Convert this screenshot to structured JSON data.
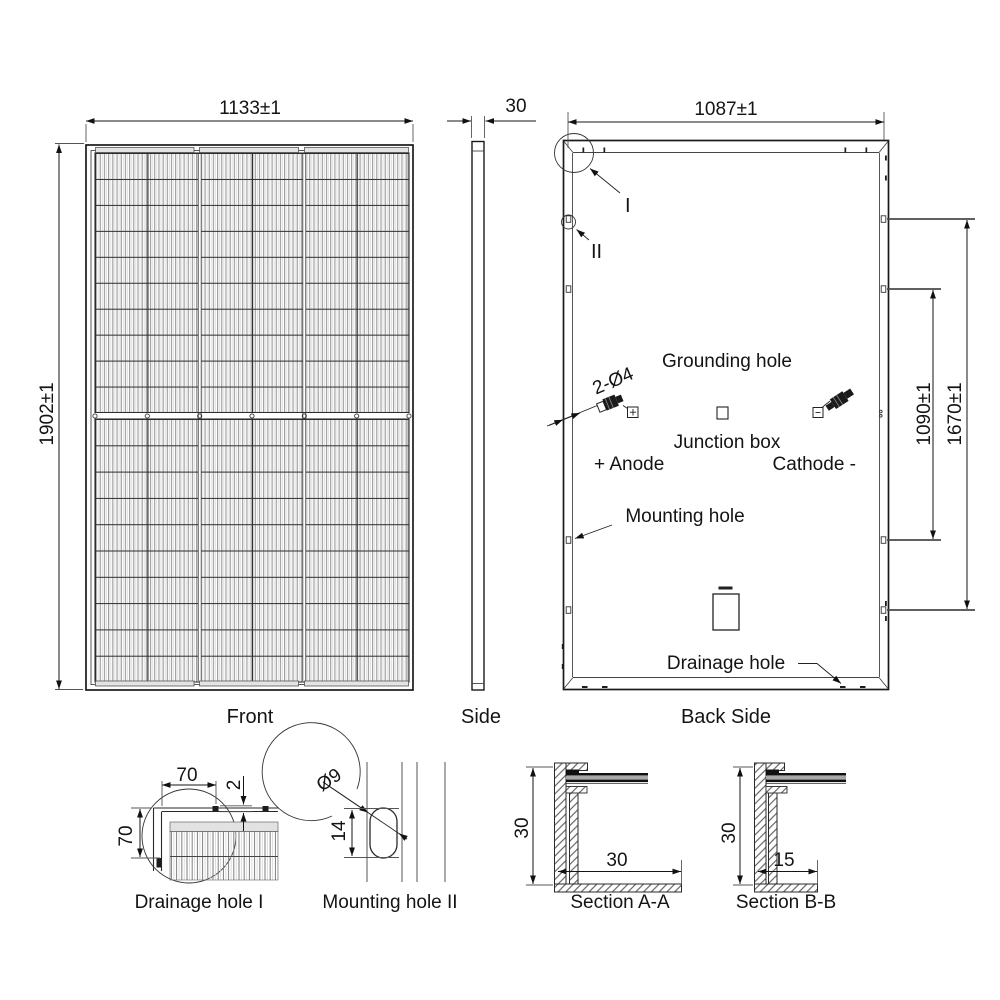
{
  "drawing": {
    "front": {
      "caption": "Front",
      "width_dim": "1133±1",
      "height_dim": "1902±1"
    },
    "side": {
      "caption": "Side",
      "thickness_dim": "30"
    },
    "back": {
      "caption": "Back Side",
      "width_dim": "1087±1",
      "inner_hole_span_dim": "1090±1",
      "outer_hole_span_dim": "1670±1",
      "grounding_hole_label": "Grounding hole",
      "grounding_hole_spec": "2-Ø4",
      "junction_box_label": "Junction box",
      "anode_label": "+ Anode",
      "cathode_label": "Cathode -",
      "mounting_hole_label": "Mounting hole",
      "drainage_hole_label": "Drainage hole",
      "detail_marker_1": "I",
      "detail_marker_2": "II"
    },
    "drainage_detail": {
      "caption": "Drainage hole I",
      "width_dim": "70",
      "height_dim": "70",
      "slot_dim": "2"
    },
    "mounting_detail": {
      "caption": "Mounting hole II",
      "diameter_dim": "Ø9",
      "length_dim": "14"
    },
    "section_aa": {
      "caption": "Section A-A",
      "height_dim": "30",
      "flange_dim": "30"
    },
    "section_bb": {
      "caption": "Section B-B",
      "height_dim": "30",
      "flange_dim": "15"
    }
  }
}
